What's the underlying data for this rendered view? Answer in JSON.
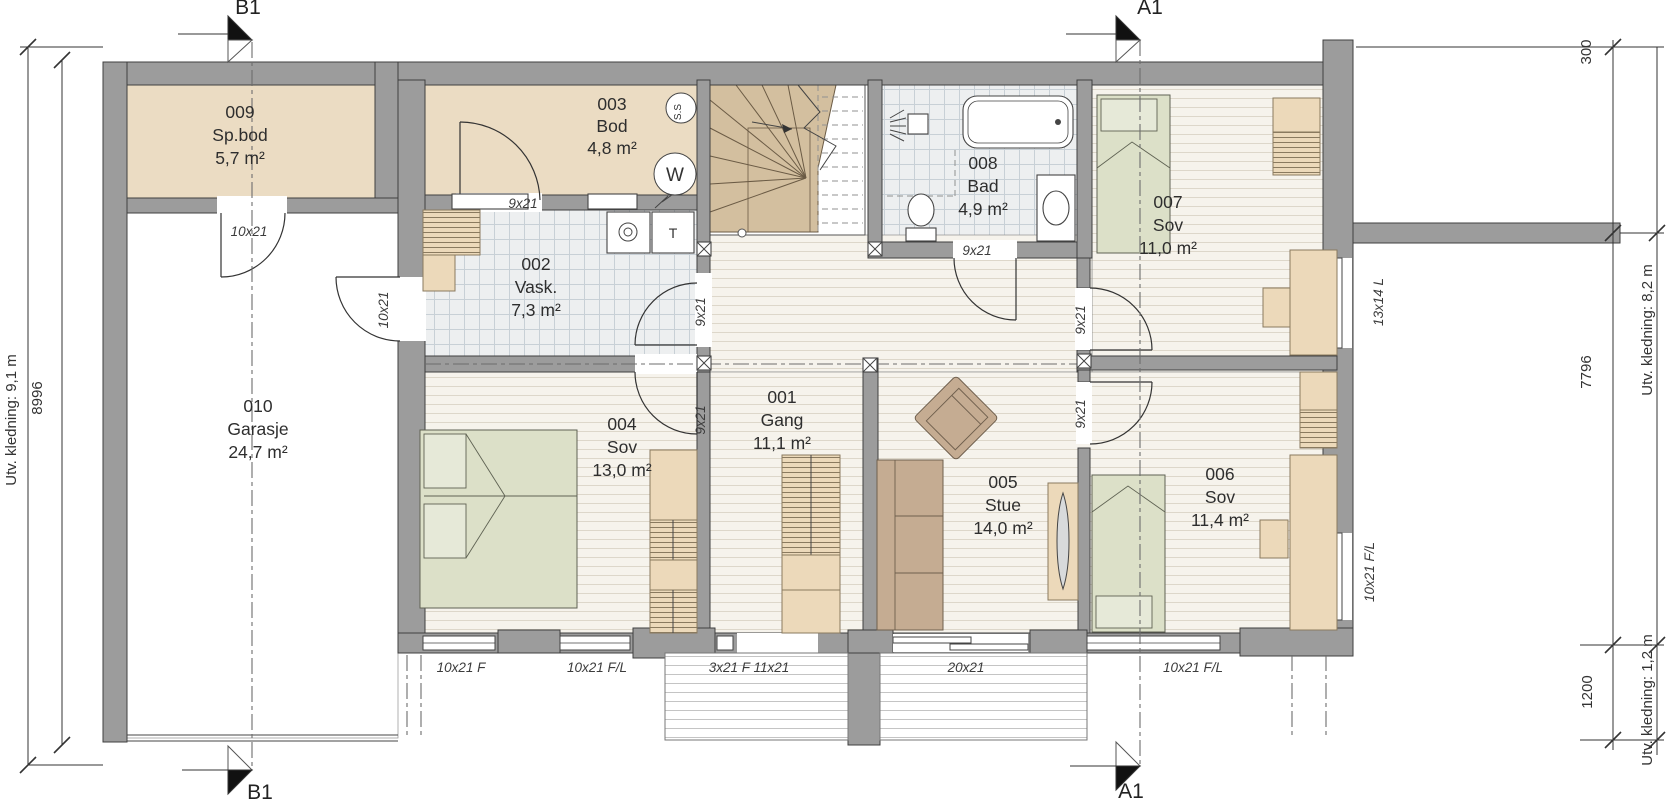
{
  "colors": {
    "wall": "#9c9c9c",
    "floor_wood_bg": "#f6f3ec",
    "floor_wood_line": "#ddd7ca",
    "floor_tile_bg": "#edeff0",
    "floor_tile_line": "#c8d0d6",
    "floor_store": "#ebdcc3",
    "furn_wood": "#ecd9ba",
    "bed_green": "#dce0c8",
    "sofa_brown": "#c5ac92",
    "stair_tan": "#d3bf9f",
    "deck_line": "#c4c4c4"
  },
  "section_markers": {
    "top_left": "B1",
    "top_right": "A1",
    "bottom_left": "B1",
    "bottom_right": "A1"
  },
  "dimensions": {
    "left_outer": "Utv. kledning: 9,1 m",
    "left_inner": "8996",
    "right_top": "300",
    "right_middle": "7796",
    "right_outer": "Utv. kledning: 8,2 m",
    "right_bottom": "1200",
    "right_outer_bottom": "Utv. kledning: 1,2 m"
  },
  "rooms": [
    {
      "number": "001",
      "name": "Gang",
      "area": "11,1 m²"
    },
    {
      "number": "002",
      "name": "Vask.",
      "area": "7,3 m²"
    },
    {
      "number": "003",
      "name": "Bod",
      "area": "4,8 m²"
    },
    {
      "number": "004",
      "name": "Sov",
      "area": "13,0 m²"
    },
    {
      "number": "005",
      "name": "Stue",
      "area": "14,0 m²"
    },
    {
      "number": "006",
      "name": "Sov",
      "area": "11,4 m²"
    },
    {
      "number": "007",
      "name": "Sov",
      "area": "11,0 m²"
    },
    {
      "number": "008",
      "name": "Bad",
      "area": "4,9 m²"
    },
    {
      "number": "009",
      "name": "Sp.bod",
      "area": "5,7 m²"
    },
    {
      "number": "010",
      "name": "Garasje",
      "area": "24,7 m²"
    }
  ],
  "opening_labels": {
    "door_sp_bod": "10x21",
    "door_garage_side": "10x21",
    "door_bod": "9x21",
    "door_vask": "9x21",
    "door_bad": "9x21",
    "door_sov_004": "9x21",
    "door_sov_006": "9x21",
    "door_sov_007": "9x21",
    "window_sov_007": "13x14 L",
    "window_sov_004_left": "10x21 F",
    "window_sov_004_right": "10x21 F/L",
    "entrance_door": "3x21 F 11x21",
    "sliding_door": "20x21",
    "window_sov_006_bottom": "10x21 F/L",
    "window_sov_006_right": "10x21 F/L"
  },
  "equipment_labels": {
    "storage_circle_top": "S.S",
    "storage_circle_bottom": "W",
    "dryer": "T"
  }
}
